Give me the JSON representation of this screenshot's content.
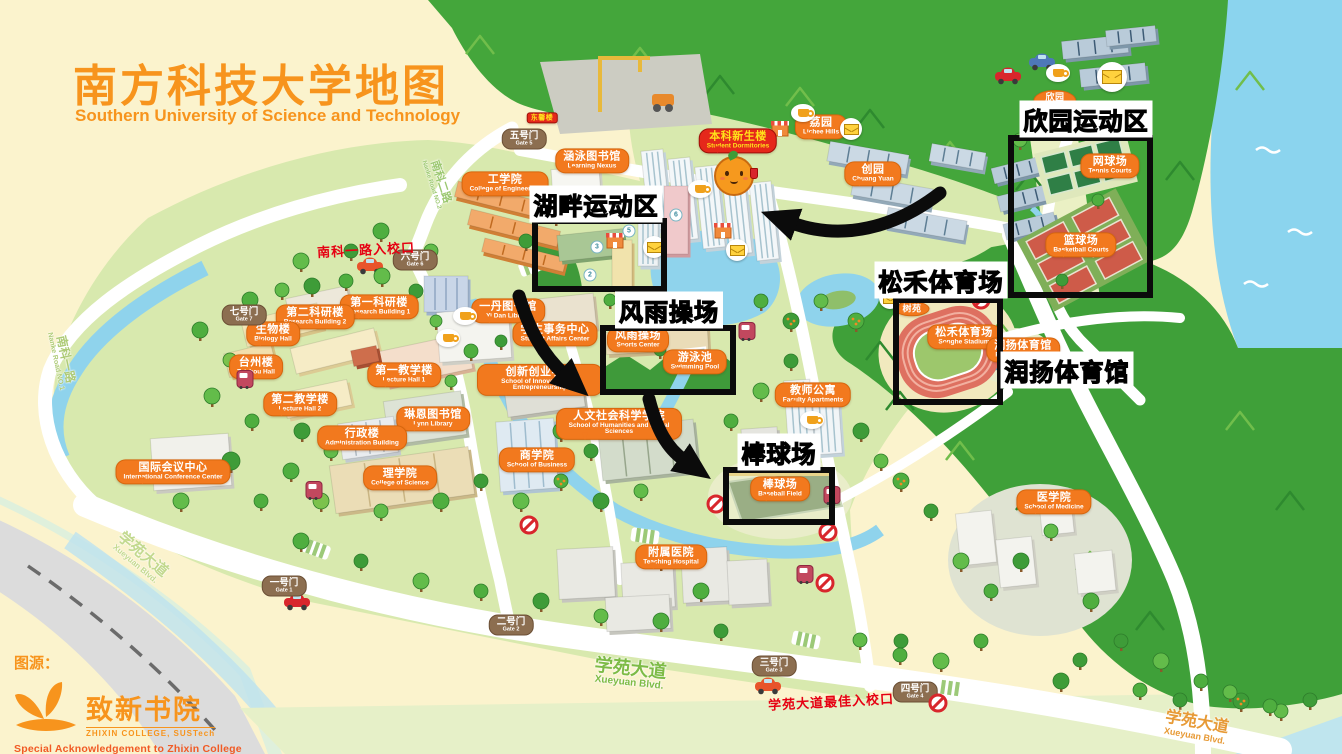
{
  "page": {
    "title_cn": "南方科技大学地图",
    "title_en": "Southern University of Science and Technology"
  },
  "attribution": {
    "source_label": "图源：",
    "college_cn": "致新书院",
    "college_en": "ZHIXIN COLLEGE, SUSTech",
    "acknowledgement": "Special Acknowledgement to Zhixin College"
  },
  "highlight_areas": [
    {
      "id": "hupan",
      "label_cn": "湖畔运动区",
      "label": {
        "x": 596,
        "y": 204
      },
      "box": {
        "x": 532,
        "y": 218,
        "w": 135,
        "h": 74
      }
    },
    {
      "id": "xinyuan",
      "label_cn": "欣园运动区",
      "label": {
        "x": 1086,
        "y": 119
      },
      "box": {
        "x": 1008,
        "y": 135,
        "w": 145,
        "h": 163
      }
    },
    {
      "id": "fengyu",
      "label_cn": "风雨操场",
      "label": {
        "x": 669,
        "y": 310
      },
      "box": {
        "x": 600,
        "y": 325,
        "w": 136,
        "h": 70
      }
    },
    {
      "id": "songhe",
      "label_cn": "松禾体育场",
      "label": {
        "x": 941,
        "y": 280
      },
      "box": {
        "x": 893,
        "y": 297,
        "w": 110,
        "h": 108
      }
    },
    {
      "id": "runyang",
      "label_cn": "润扬体育馆",
      "label": {
        "x": 1067,
        "y": 370
      },
      "box": null
    },
    {
      "id": "baseball",
      "label_cn": "棒球场",
      "label": {
        "x": 779,
        "y": 452
      },
      "box": {
        "x": 723,
        "y": 467,
        "w": 112,
        "h": 58
      }
    }
  ],
  "buildings": [
    {
      "cn": "工学院",
      "en": "College of Engineering",
      "x": 505,
      "y": 184
    },
    {
      "cn": "涵泳图书馆",
      "en": "Learning Nexus",
      "x": 592,
      "y": 161
    },
    {
      "cn": "本科新生楼",
      "en": "Student Dormitories",
      "x": 738,
      "y": 141,
      "style": "red"
    },
    {
      "cn": "东馨楼",
      "en": "",
      "x": 542,
      "y": 118,
      "style": "redmini"
    },
    {
      "cn": "荔园",
      "en": "Lichee Hills",
      "x": 821,
      "y": 127
    },
    {
      "cn": "创园",
      "en": "Chuang Yuan",
      "x": 873,
      "y": 174
    },
    {
      "cn": "欣园",
      "en": "Xin Yuan",
      "x": 1055,
      "y": 101,
      "style": "mini"
    },
    {
      "cn": "网球场",
      "en": "Tennis Courts",
      "x": 1110,
      "y": 166
    },
    {
      "cn": "篮球场",
      "en": "Basketball Courts",
      "x": 1081,
      "y": 245
    },
    {
      "cn": "树苑",
      "en": "",
      "x": 912,
      "y": 309,
      "style": "mini"
    },
    {
      "cn": "第一科研楼",
      "en": "Research Building 1",
      "x": 379,
      "y": 307
    },
    {
      "cn": "第二科研楼",
      "en": "Research Building 2",
      "x": 315,
      "y": 317
    },
    {
      "cn": "生物楼",
      "en": "Biology Hall",
      "x": 273,
      "y": 334
    },
    {
      "cn": "台州楼",
      "en": "Taizhou Hall",
      "x": 256,
      "y": 367
    },
    {
      "cn": "第一教学楼",
      "en": "Lecture Hall 1",
      "x": 404,
      "y": 375
    },
    {
      "cn": "第二教学楼",
      "en": "Lecture Hall 2",
      "x": 300,
      "y": 404
    },
    {
      "cn": "琳恩图书馆",
      "en": "Lynn Library",
      "x": 433,
      "y": 419
    },
    {
      "cn": "行政楼",
      "en": "Administration Building",
      "x": 362,
      "y": 438
    },
    {
      "cn": "国际会议中心",
      "en": "International Conference Center",
      "x": 173,
      "y": 472
    },
    {
      "cn": "理学院",
      "en": "College of Science",
      "x": 400,
      "y": 478
    },
    {
      "cn": "商学院",
      "en": "School of Business",
      "x": 537,
      "y": 460
    },
    {
      "cn": "一丹图书馆",
      "en": "Yi Dan Library",
      "x": 508,
      "y": 311
    },
    {
      "cn": "学生事务中心",
      "en": "Student Affairs Center",
      "x": 555,
      "y": 334
    },
    {
      "cn": "创新创业学院",
      "en": "School of Innovation and Entrepreneurship",
      "x": 540,
      "y": 380
    },
    {
      "cn": "人文社会科学学院",
      "en": "School of Humanities and Social Sciences",
      "x": 619,
      "y": 424
    },
    {
      "cn": "教师公寓",
      "en": "Faculty Apartments",
      "x": 813,
      "y": 395
    },
    {
      "cn": "附属医院",
      "en": "Teaching Hospital",
      "x": 671,
      "y": 557
    },
    {
      "cn": "医学院",
      "en": "School of Medicine",
      "x": 1054,
      "y": 502
    },
    {
      "cn": "风雨操场",
      "en": "Sports Center",
      "x": 638,
      "y": 340
    },
    {
      "cn": "游泳池",
      "en": "Swimming Pool",
      "x": 695,
      "y": 362
    },
    {
      "cn": "松禾体育场",
      "en": "Songhe Stadium",
      "x": 964,
      "y": 337
    },
    {
      "cn": "润扬体育馆",
      "en": "Runyang Stadium",
      "x": 1023,
      "y": 350
    },
    {
      "cn": "棒球场",
      "en": "Baseball Field",
      "x": 780,
      "y": 489
    }
  ],
  "gates": [
    {
      "cn": "五号门",
      "en": "Gate 5",
      "x": 524,
      "y": 139
    },
    {
      "cn": "六号门",
      "en": "Gate 6",
      "x": 415,
      "y": 260
    },
    {
      "cn": "七号门",
      "en": "Gate 7",
      "x": 244,
      "y": 315
    },
    {
      "cn": "一号门",
      "en": "Gate 1",
      "x": 284,
      "y": 586
    },
    {
      "cn": "二号门",
      "en": "Gate 2",
      "x": 511,
      "y": 625
    },
    {
      "cn": "三号门",
      "en": "Gate 3",
      "x": 774,
      "y": 666
    },
    {
      "cn": "四号门",
      "en": "Gate 4",
      "x": 915,
      "y": 692
    }
  ],
  "road_labels": [
    {
      "cn": "南科二路",
      "en": "Nanke Road NO.2",
      "x": 437,
      "y": 183,
      "rot": 72,
      "color": "#9CC871",
      "size": 11
    },
    {
      "cn": "南科一路",
      "en": "Nanke Road NO.1",
      "x": 62,
      "y": 360,
      "rot": 78,
      "color": "#AECB77",
      "size": 12
    },
    {
      "cn": "学苑大道",
      "en": "Xueyuan Blvd.",
      "x": 140,
      "y": 558,
      "rot": 40,
      "color": "#C2D98E",
      "size": 15
    },
    {
      "cn": "学苑大道",
      "en": "Xueyuan Blvd.",
      "x": 630,
      "y": 674,
      "rot": 6,
      "color": "#7DBB46",
      "size": 18
    },
    {
      "cn": "学苑大道",
      "en": "Xueyuan Blvd.",
      "x": 1196,
      "y": 728,
      "rot": 10,
      "color": "#E79A36",
      "size": 16
    }
  ],
  "entrance_notes": [
    {
      "text": "南科一路入校口",
      "x": 366,
      "y": 249
    },
    {
      "text": "学苑大道最佳入校口",
      "x": 831,
      "y": 701
    }
  ],
  "icons": {
    "envelopes": [
      [
        654,
        247
      ],
      [
        737,
        250
      ],
      [
        890,
        298
      ],
      [
        851,
        129
      ],
      [
        1112,
        77
      ]
    ],
    "coffee_cups": [
      [
        1058,
        73
      ],
      [
        700,
        189
      ],
      [
        803,
        113
      ],
      [
        465,
        316
      ],
      [
        448,
        338
      ],
      [
        812,
        420
      ]
    ],
    "bus_stops": [
      [
        245,
        379
      ],
      [
        747,
        331
      ],
      [
        832,
        495
      ],
      [
        805,
        574
      ],
      [
        314,
        490
      ]
    ],
    "no_entry_signs": [
      [
        529,
        525
      ],
      [
        716,
        504
      ],
      [
        828,
        532
      ],
      [
        825,
        583
      ],
      [
        938,
        703
      ],
      [
        981,
        300
      ]
    ],
    "tower_numbers": [
      {
        "n": "5",
        "x": 629,
        "y": 231
      },
      {
        "n": "6",
        "x": 676,
        "y": 215
      },
      {
        "n": "3",
        "x": 597,
        "y": 247
      },
      {
        "n": "2",
        "x": 590,
        "y": 275
      }
    ]
  },
  "mascot": {
    "x": 734,
    "y": 176
  },
  "colors": {
    "background": "#FBF3CD",
    "accent_orange": "#F7941D",
    "bubble_orange": "#F2791E",
    "forest_green": "#44A63B",
    "campus_green": "#D8E9AE",
    "water_blue": "#8BD4EE",
    "highlight_black": "#0B0B0B",
    "red_note": "#E60012"
  }
}
